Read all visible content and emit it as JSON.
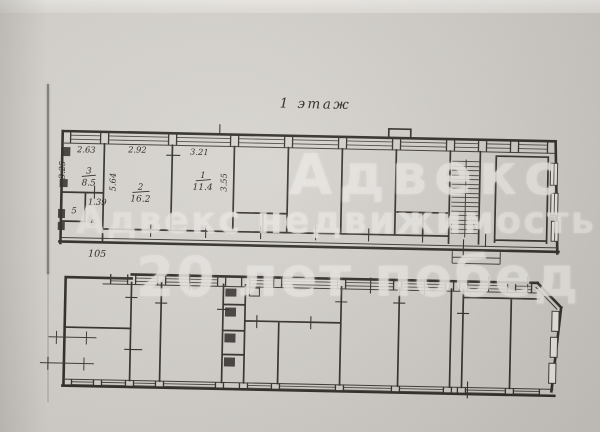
{
  "colors": {
    "paper": "#d6d3ce",
    "ink": "#26231f",
    "watermark": "#e7e4e0"
  },
  "plan": {
    "title": "1 этаж",
    "upper_building": {
      "dim_top_room3": "2.63",
      "dim_top_room2": "2.92",
      "dim_top_room1": "3.21",
      "dim_left_room3": "3.25",
      "dim_left_room2": "5.64",
      "dim_right_room1": "3.55",
      "dim_lobby": "1.39",
      "dim_bottom": "105",
      "rooms": [
        {
          "number": "3",
          "area": "8.5"
        },
        {
          "number": "2",
          "area": "16.2"
        },
        {
          "number": "1",
          "area": "11.4"
        },
        {
          "number": "5"
        },
        {
          "number": "6"
        }
      ]
    },
    "watermark": {
      "line_top": "Адвекс",
      "line_middle": "Адвекс недвижимость",
      "line_bottom": "20 лет побед"
    }
  }
}
